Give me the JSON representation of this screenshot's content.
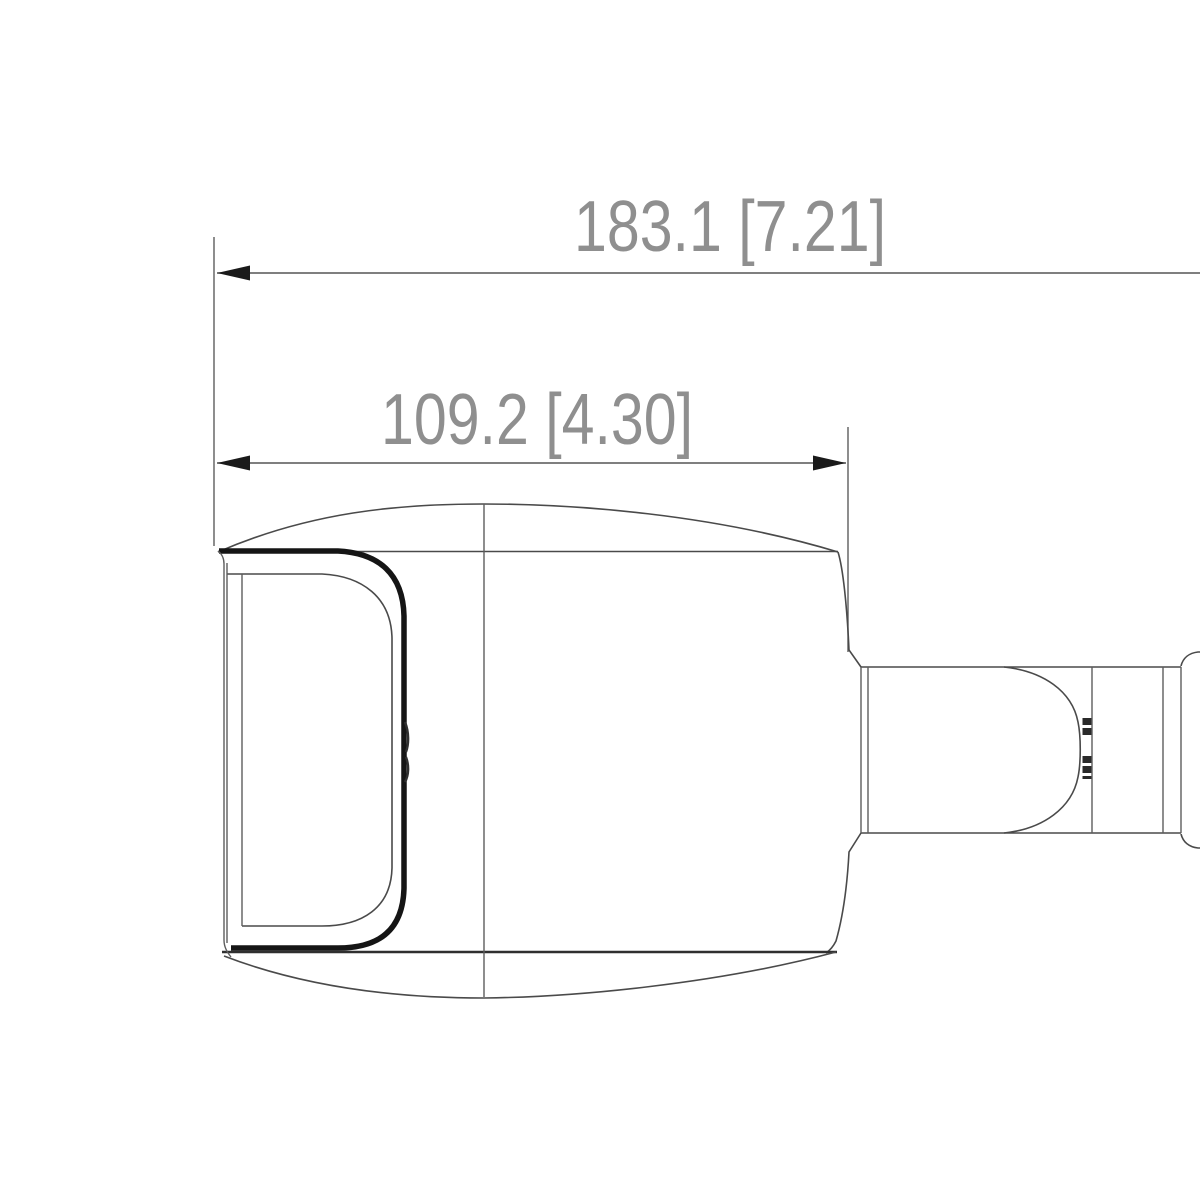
{
  "drawing": {
    "type": "technical-dimension-drawing",
    "subject": "bullet-security-camera-side-view",
    "background_color": "#ffffff",
    "outline_color": "#4a4a4a",
    "heavy_outline_color": "#151515",
    "dimension_line_color": "#555555",
    "dimension_text_color": "#8f8f8f",
    "dimensions": [
      {
        "id": "overall-length",
        "label": "183.1 [7.21]",
        "value_mm": 183.1,
        "value_in": 7.21
      },
      {
        "id": "body-length",
        "label": "109.2 [4.30]",
        "value_mm": 109.2,
        "value_in": 4.3
      }
    ]
  }
}
